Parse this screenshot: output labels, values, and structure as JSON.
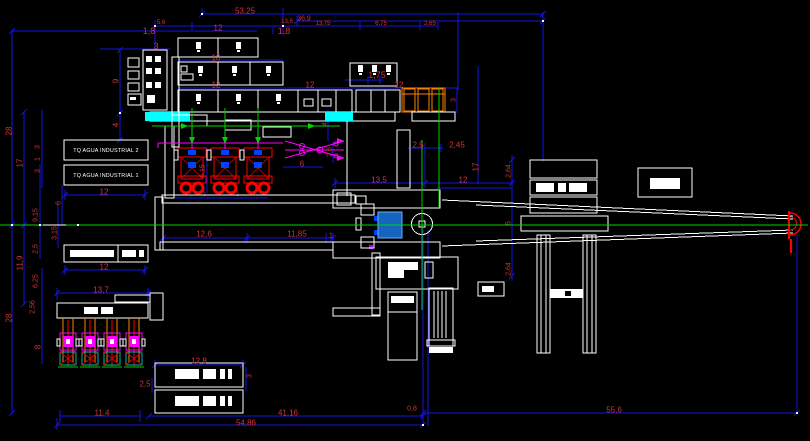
{
  "app": {
    "type": "cad-plant-plan",
    "view": "hydroelectric-industrial-plant-layout"
  },
  "colors": {
    "background": "#000000",
    "dimension_line": "#1414e6",
    "dimension_text": "#d23434",
    "outline_white": "#ffffff",
    "hatch_cyan": "#00ffff",
    "pipe_green": "#00d400",
    "pipe_magenta": "#ff00ff",
    "equipment_red": "#ff0000",
    "equipment_orange": "#ff7f00",
    "generator_fill": "#1565c0",
    "transformer_teal": "#00b3b3"
  },
  "labels": {
    "tank2": "TQ AGUA INDUSTRIAL 2",
    "tank1": "TQ AGUA INDUSTRIAL 1"
  },
  "dimensions": [
    {
      "text": "53,25",
      "x": 245,
      "y": 11,
      "rot": 0,
      "size": 8
    },
    {
      "text": "36,9",
      "x": 304,
      "y": 19,
      "rot": 0,
      "size": 7
    },
    {
      "text": "5,6",
      "x": 161,
      "y": 23,
      "rot": 0,
      "size": 6
    },
    {
      "text": "13,6",
      "x": 287,
      "y": 22,
      "rot": 0,
      "size": 6
    },
    {
      "text": "13,75",
      "x": 323,
      "y": 24,
      "rot": 0,
      "size": 6
    },
    {
      "text": "6,75",
      "x": 381,
      "y": 24,
      "rot": 0,
      "size": 6
    },
    {
      "text": "2,65",
      "x": 430,
      "y": 24,
      "rot": 0,
      "size": 6
    },
    {
      "text": "1,8",
      "x": 149,
      "y": 31,
      "rot": 0,
      "size": 9
    },
    {
      "text": "1,8",
      "x": 284,
      "y": 31,
      "rot": 0,
      "size": 9
    },
    {
      "text": "12",
      "x": 218,
      "y": 28,
      "rot": 0,
      "size": 8
    },
    {
      "text": "3",
      "x": 156,
      "y": 46,
      "rot": 0,
      "size": 9
    },
    {
      "text": "18",
      "x": 216,
      "y": 58,
      "rot": 0,
      "size": 8
    },
    {
      "text": "12",
      "x": 216,
      "y": 85,
      "rot": 0,
      "size": 8
    },
    {
      "text": "12",
      "x": 310,
      "y": 85,
      "rot": 0,
      "size": 8
    },
    {
      "text": "12",
      "x": 399,
      "y": 85,
      "rot": 0,
      "size": 8
    },
    {
      "text": "1,75",
      "x": 377,
      "y": 75,
      "rot": 0,
      "size": 9
    },
    {
      "text": "9",
      "x": 116,
      "y": 81,
      "rot": -90,
      "size": 8
    },
    {
      "text": "4",
      "x": 116,
      "y": 125,
      "rot": -90,
      "size": 8
    },
    {
      "text": "28",
      "x": 9,
      "y": 131,
      "rot": -90,
      "size": 8
    },
    {
      "text": "17",
      "x": 20,
      "y": 163,
      "rot": -90,
      "size": 8
    },
    {
      "text": "3",
      "x": 38,
      "y": 147,
      "rot": -90,
      "size": 7
    },
    {
      "text": "1",
      "x": 38,
      "y": 159,
      "rot": -90,
      "size": 7
    },
    {
      "text": "3",
      "x": 38,
      "y": 171,
      "rot": -90,
      "size": 7
    },
    {
      "text": "6",
      "x": 59,
      "y": 203,
      "rot": -90,
      "size": 7
    },
    {
      "text": "9,15",
      "x": 36,
      "y": 215,
      "rot": -90,
      "size": 7
    },
    {
      "text": "3,15",
      "x": 55,
      "y": 233,
      "rot": -90,
      "size": 7
    },
    {
      "text": "2,5",
      "x": 36,
      "y": 249,
      "rot": -90,
      "size": 7
    },
    {
      "text": "11,9",
      "x": 20,
      "y": 263,
      "rot": -90,
      "size": 8
    },
    {
      "text": "6,15",
      "x": 203,
      "y": 171,
      "rot": -90,
      "size": 7
    },
    {
      "text": "4",
      "x": 325,
      "y": 124,
      "rot": -90,
      "size": 7
    },
    {
      "text": "2,6",
      "x": 330,
      "y": 152,
      "rot": -90,
      "size": 7
    },
    {
      "text": "6",
      "x": 302,
      "y": 164,
      "rot": 0,
      "size": 8
    },
    {
      "text": "3",
      "x": 186,
      "y": 195,
      "rot": 0,
      "size": 6
    },
    {
      "text": "2",
      "x": 204,
      "y": 195,
      "rot": 0,
      "size": 6
    },
    {
      "text": "3",
      "x": 220,
      "y": 195,
      "rot": 0,
      "size": 6
    },
    {
      "text": "2",
      "x": 237,
      "y": 195,
      "rot": 0,
      "size": 6
    },
    {
      "text": "3",
      "x": 254,
      "y": 195,
      "rot": 0,
      "size": 6
    },
    {
      "text": "2,5",
      "x": 418,
      "y": 145,
      "rot": 0,
      "size": 8
    },
    {
      "text": "2,45",
      "x": 457,
      "y": 145,
      "rot": 0,
      "size": 8
    },
    {
      "text": "3",
      "x": 454,
      "y": 100,
      "rot": -90,
      "size": 7
    },
    {
      "text": "17",
      "x": 476,
      "y": 167,
      "rot": -90,
      "size": 8
    },
    {
      "text": "13,5",
      "x": 379,
      "y": 180,
      "rot": 0,
      "size": 8
    },
    {
      "text": "12",
      "x": 463,
      "y": 180,
      "rot": 0,
      "size": 8
    },
    {
      "text": "2,64",
      "x": 509,
      "y": 171,
      "rot": -90,
      "size": 7
    },
    {
      "text": "5",
      "x": 509,
      "y": 223,
      "rot": -90,
      "size": 7
    },
    {
      "text": "2,64",
      "x": 509,
      "y": 269,
      "rot": -90,
      "size": 7
    },
    {
      "text": "12",
      "x": 104,
      "y": 192,
      "rot": 0,
      "size": 8
    },
    {
      "text": "12,6",
      "x": 204,
      "y": 234,
      "rot": 0,
      "size": 8
    },
    {
      "text": "11,85",
      "x": 297,
      "y": 234,
      "rot": 0,
      "size": 8
    },
    {
      "text": "1",
      "x": 331,
      "y": 236,
      "rot": 0,
      "size": 7
    },
    {
      "text": "12",
      "x": 104,
      "y": 267,
      "rot": 0,
      "size": 8
    },
    {
      "text": "28",
      "x": 9,
      "y": 318,
      "rot": -90,
      "size": 8
    },
    {
      "text": "6,25",
      "x": 36,
      "y": 281,
      "rot": -90,
      "size": 7
    },
    {
      "text": "2,56",
      "x": 33,
      "y": 307,
      "rot": -90,
      "size": 7
    },
    {
      "text": "8",
      "x": 38,
      "y": 347,
      "rot": -90,
      "size": 8
    },
    {
      "text": "13,7",
      "x": 101,
      "y": 290,
      "rot": 0,
      "size": 8
    },
    {
      "text": "12,8",
      "x": 199,
      "y": 361,
      "rot": 0,
      "size": 8
    },
    {
      "text": "3",
      "x": 250,
      "y": 376,
      "rot": -90,
      "size": 7
    },
    {
      "text": "2,5",
      "x": 145,
      "y": 384,
      "rot": 0,
      "size": 8
    },
    {
      "text": "11,4",
      "x": 102,
      "y": 413,
      "rot": 0,
      "size": 8
    },
    {
      "text": "41,16",
      "x": 288,
      "y": 413,
      "rot": 0,
      "size": 8
    },
    {
      "text": "0,8",
      "x": 412,
      "y": 409,
      "rot": 0,
      "size": 7
    },
    {
      "text": "54,86",
      "x": 246,
      "y": 423,
      "rot": 0,
      "size": 8
    },
    {
      "text": "55,6",
      "x": 614,
      "y": 410,
      "rot": 0,
      "size": 8
    }
  ]
}
